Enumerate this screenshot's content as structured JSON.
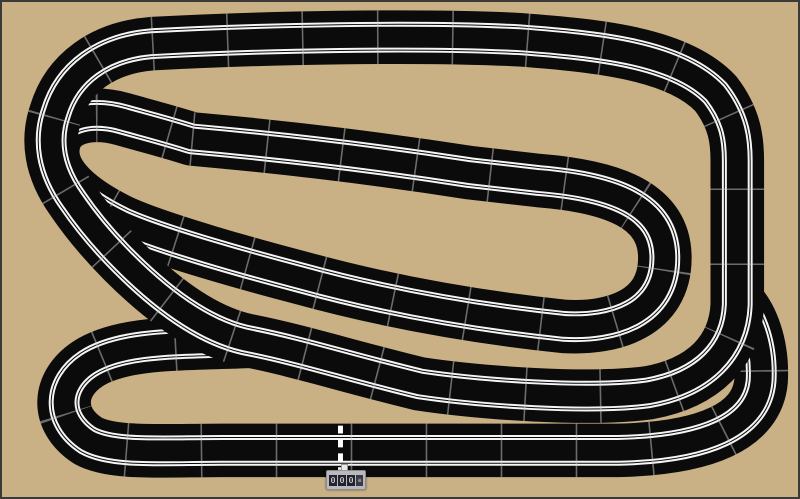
{
  "app": {
    "title": "Slot car track layout plan"
  },
  "canvas": {
    "width": 800,
    "height": 499,
    "background_color": "#c9b185",
    "border_color": "#3b3a38"
  },
  "track": {
    "surface_color": "#0b0b0b",
    "lane_color": "#f5f5f5",
    "joint_color": "rgba(205,205,205,0.5)",
    "stroke_layers": [
      [
        "surface",
        54
      ],
      [
        "lane",
        31
      ],
      [
        "surface",
        27
      ],
      [
        "lane",
        25
      ],
      [
        "surface",
        21
      ]
    ],
    "joint_layer": {
      "width": 54,
      "dash": "1.6 74"
    },
    "strands": [
      {
        "name": "inner-circuit",
        "d": "M190,138 C280,146 380,158 470,172 L540,180 C615,186 667,205 667,258 C667,314 615,330 565,327 C470,317 380,300 300,278 C250,265 160,240 120,222 C75,200 48,175 50,148 C52,118 85,108 120,118 C145,125 165,130 190,138 Z"
      },
      {
        "name": "bottom-bypass-loop",
        "d": "M250,342 C180,345 120,342 85,365 C55,385 52,420 85,442 C110,456 160,452 220,452 L620,452 C708,450 760,428 764,382 C766,345 754,316 740,302"
      },
      {
        "name": "outer-circuit",
        "d": "M150,42 C260,36 420,33 520,38 C600,44 680,52 718,92 C738,118 740,140 740,160 L740,305 C738,352 706,384 650,394 C590,402 480,394 420,385 C350,368 300,352 250,342 C205,334 160,300 122,262 C100,240 85,222 70,200 C47,168 44,138 53,112 C65,72 100,46 150,42 Z"
      }
    ],
    "start_line": {
      "x": 340,
      "y1": 427,
      "y2": 479,
      "color": "#ffffff",
      "dash": "8 6",
      "width": 5
    }
  },
  "lap_counter": {
    "digits": [
      "0",
      "0",
      "0"
    ],
    "side_glyph": "≡",
    "body_color": "#b9b9be",
    "cell_color": "#23232e",
    "digit_color": "#f0f0f0"
  }
}
